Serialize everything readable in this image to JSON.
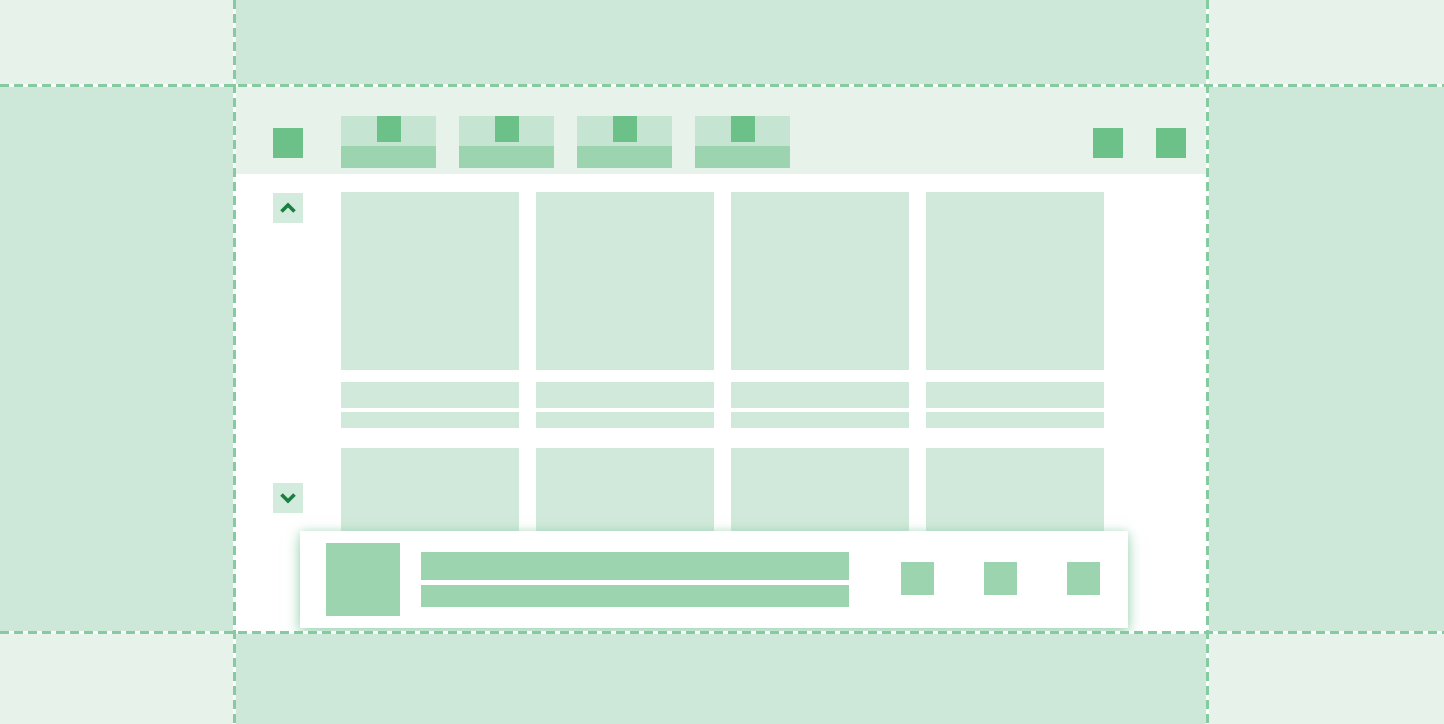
{
  "colors": {
    "background_light": "#e6f2ea",
    "background_medium": "#cde8d8",
    "surface_white": "#ffffff",
    "placeholder_light": "#d1e9db",
    "tab_inactive": "#c5e4d1",
    "element_medium": "#9cd4af",
    "accent_green": "#6bc187",
    "chevron_bg": "#d2ebdc",
    "chevron_green": "#1c7f42",
    "dash_green": "#85caa0"
  },
  "browser_chrome": {
    "logo_icon": "app-logo-square-icon",
    "tab_count": 4,
    "tab_favicon_icon": "favicon-square-icon",
    "toolbar_button_count": 2,
    "toolbar_button_icon": "toolbar-square-icon"
  },
  "scroll_controls": {
    "up_icon": "chevron-up-icon",
    "down_icon": "chevron-down-icon"
  },
  "content_grid": {
    "row1_card_count": 4,
    "row1_text_lines_per_card": 2,
    "row2_card_count": 4
  },
  "banner": {
    "thumbnail_icon": "image-placeholder-square",
    "text_line_count": 2,
    "action_button_count": 3
  },
  "viewport_guides": {
    "line_style": "dashed",
    "line_count": 4
  }
}
